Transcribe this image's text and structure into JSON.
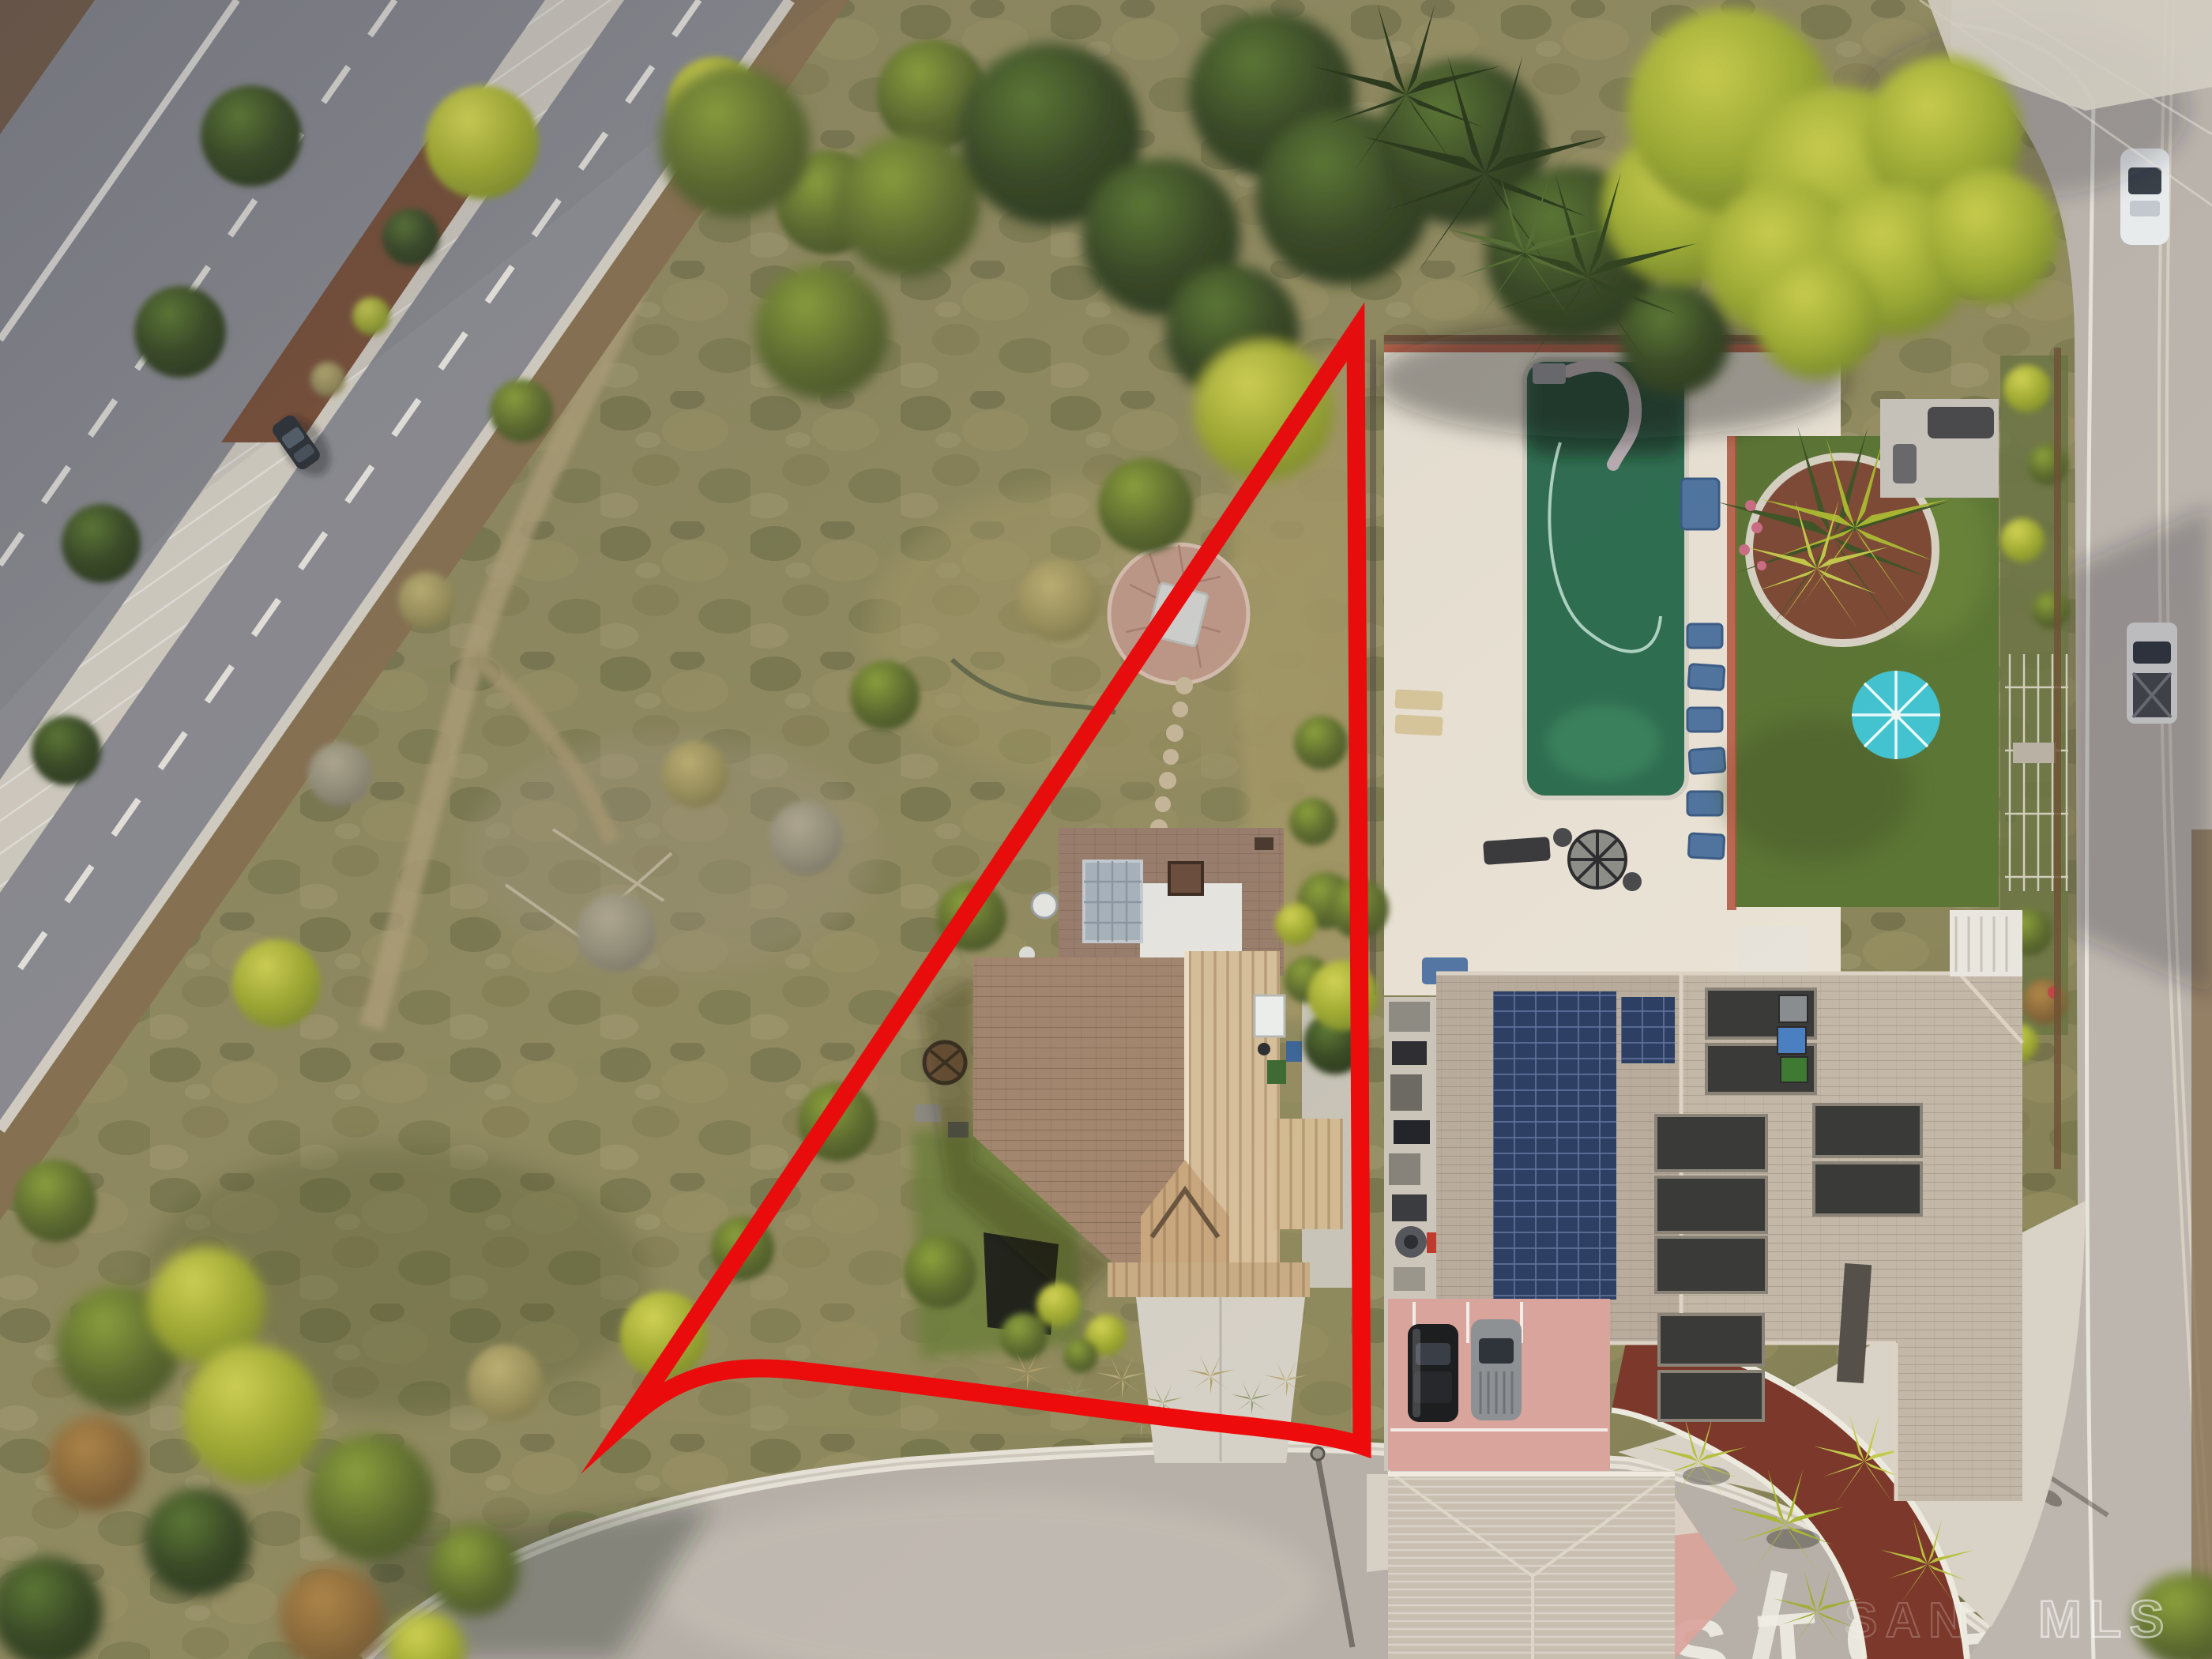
{
  "scene": {
    "stop_marking": "STOP",
    "watermark_faint": "SAN",
    "watermark_main": "MLS"
  },
  "colors": {
    "boundary_red": "#ee0b0b",
    "pool_water": "#2f6e51",
    "umbrella_teal": "#43c4d0",
    "solar_pv_blue": "#2d3f63",
    "mulch_red": "#7c392b",
    "driveway_pink": "#d9a49b",
    "lawn_green": "#5c7635",
    "pool_deck_cream": "#eae3d5",
    "asphalt_left": "#8e8e93",
    "street_gray": "#b7b0a8",
    "right_road_gray": "#bdb6ae",
    "subject_roof_brown": "#a5876f",
    "subject_roof_tan": "#d8c09b",
    "neighbor_roof_gray": "#b9ac9d",
    "brush_olive": "#8b865c",
    "concrete_light": "#d9d3c7"
  }
}
